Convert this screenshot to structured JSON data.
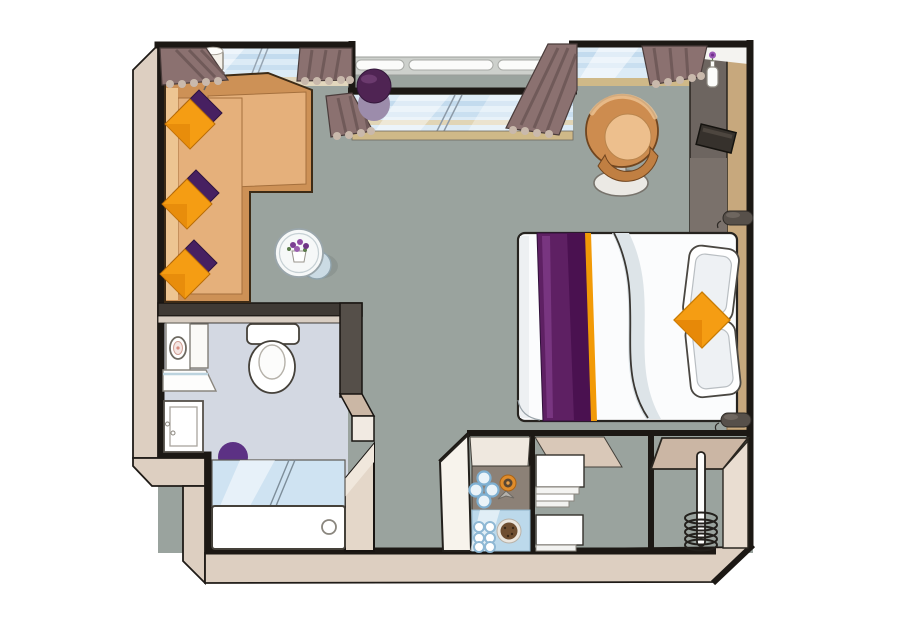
{
  "colors": {
    "background": "#ffffff",
    "wall_outline": "#1c1814",
    "wall_beige": "#ddcfc1",
    "floor": "#9aa39e",
    "bathroom_floor": "#d3d8e2",
    "railing": "#cdd0cc",
    "glazing": "#dcebf6",
    "sill": "#cfb988",
    "curtain": "#8b7170",
    "curtain_trim": "#c9b9ac",
    "sofa": "#cd9156",
    "sofa_seat": "#e5b07b",
    "cushion_orange": "#f59d13",
    "cushion_purple": "#472061",
    "bed_white": "#fbfcfd",
    "runner_purple": "#5e2063",
    "runner_orange": "#f29a07",
    "headboard_wood": "#c7a87d",
    "cabinet_dark": "#6d6560",
    "counter": "#8c8177",
    "tray_blue": "#bcd9eb",
    "stool_purple": "#5c3184",
    "pouf_purple": "#4f2453",
    "closet_top": "#cbb6a4"
  }
}
